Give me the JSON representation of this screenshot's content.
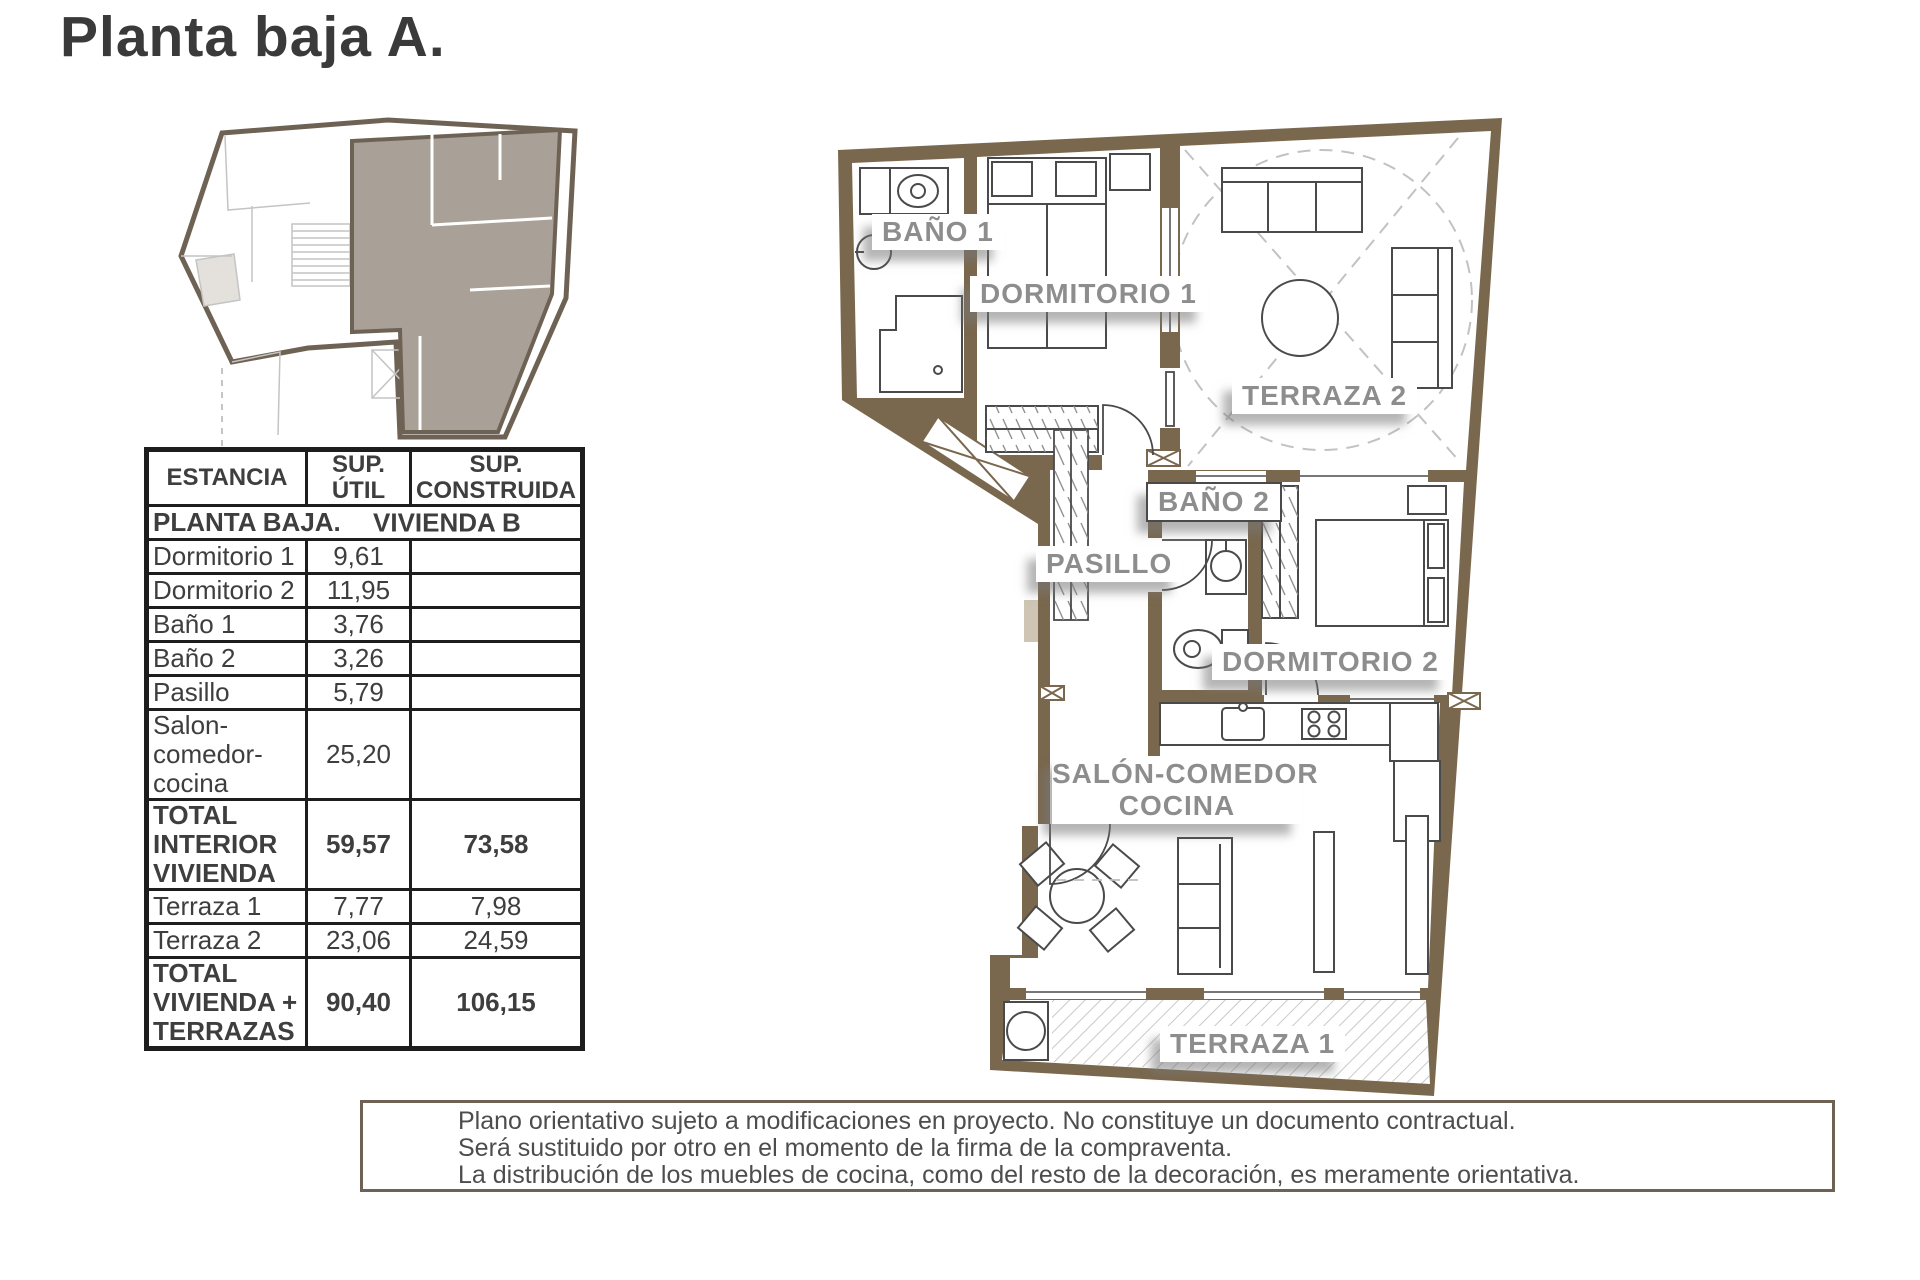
{
  "title": "Planta baja A.",
  "table": {
    "headers": [
      "ESTANCIA",
      "SUP. ÚTIL",
      "SUP. CONSTRUIDA"
    ],
    "section": {
      "left": "PLANTA BAJA.",
      "right": "VIVIENDA B"
    },
    "rows": [
      {
        "name": "Dormitorio 1",
        "util": "9,61",
        "construida": ""
      },
      {
        "name": "Dormitorio 2",
        "util": "11,95",
        "construida": ""
      },
      {
        "name": "Baño 1",
        "util": "3,76",
        "construida": ""
      },
      {
        "name": "Baño 2",
        "util": "3,26",
        "construida": ""
      },
      {
        "name": "Pasillo",
        "util": "5,79",
        "construida": ""
      },
      {
        "name": "Salon-comedor-cocina",
        "util": "25,20",
        "construida": ""
      },
      {
        "name": "TOTAL INTERIOR VIVIENDA",
        "util": "59,57",
        "construida": "73,58"
      },
      {
        "name": "Terraza 1",
        "util": "7,77",
        "construida": "7,98"
      },
      {
        "name": "Terraza 2",
        "util": "23,06",
        "construida": "24,59"
      },
      {
        "name": "TOTAL VIVIENDA + TERRAZAS",
        "util": "90,40",
        "construida": "106,15"
      }
    ]
  },
  "plan": {
    "labels": {
      "bano1": "BAÑO 1",
      "dormitorio1": "DORMITORIO 1",
      "terraza2": "TERRAZA 2",
      "bano2": "BAÑO 2",
      "pasillo": "PASILLO",
      "dormitorio2": "DORMITORIO 2",
      "salon_line1": "SALÓN-COMEDOR",
      "salon_line2": "COCINA",
      "terraza1": "TERRAZA 1"
    }
  },
  "disclaimer": {
    "lines": [
      "Plano orientativo sujeto a modificaciones en proyecto. No constituye un documento contractual.",
      "Será sustituido por otro en el momento de la firma de la compraventa.",
      "La distribución de los muebles de cocina, como del resto de la decoración, es meramente orientativa."
    ]
  },
  "colors": {
    "wall_brown": "#7a684e",
    "key_plan_unit_fill": "#a9a098",
    "label_gray": "#8d8d8d"
  }
}
